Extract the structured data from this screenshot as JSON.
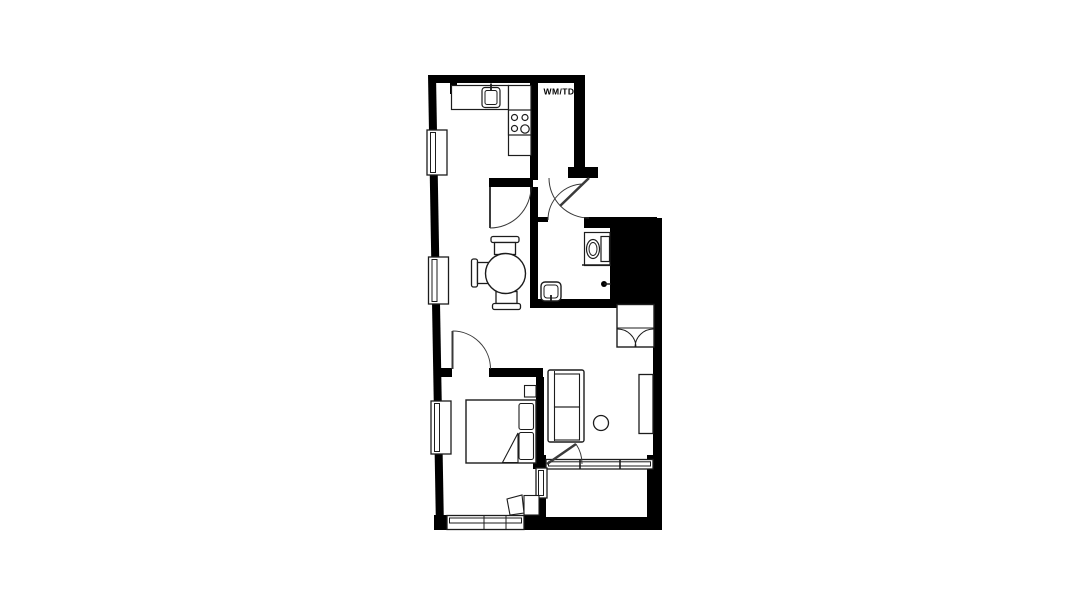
{
  "plan": {
    "label": "WM/TD",
    "colors": {
      "walls": "#000000",
      "lines": "#1c1c1c",
      "doors": "#3a3a3a",
      "background": "#ffffff"
    },
    "fixtures": [
      "kitchen-counter",
      "kitchen-sink",
      "cooktop-4-burners",
      "washer-dryer-closet",
      "entry-door",
      "kitchen-door",
      "dining-table-round",
      "dining-chair",
      "bathroom-toilet",
      "bathroom-sink",
      "shower-outlet",
      "service-shaft",
      "wardrobe-double-door",
      "sofa-two-seat",
      "side-table-round",
      "sideboard",
      "double-bed",
      "pillows",
      "blanket-fold",
      "nightstand",
      "desk",
      "desk-chair",
      "balcony",
      "window",
      "balcony-glazing"
    ]
  }
}
